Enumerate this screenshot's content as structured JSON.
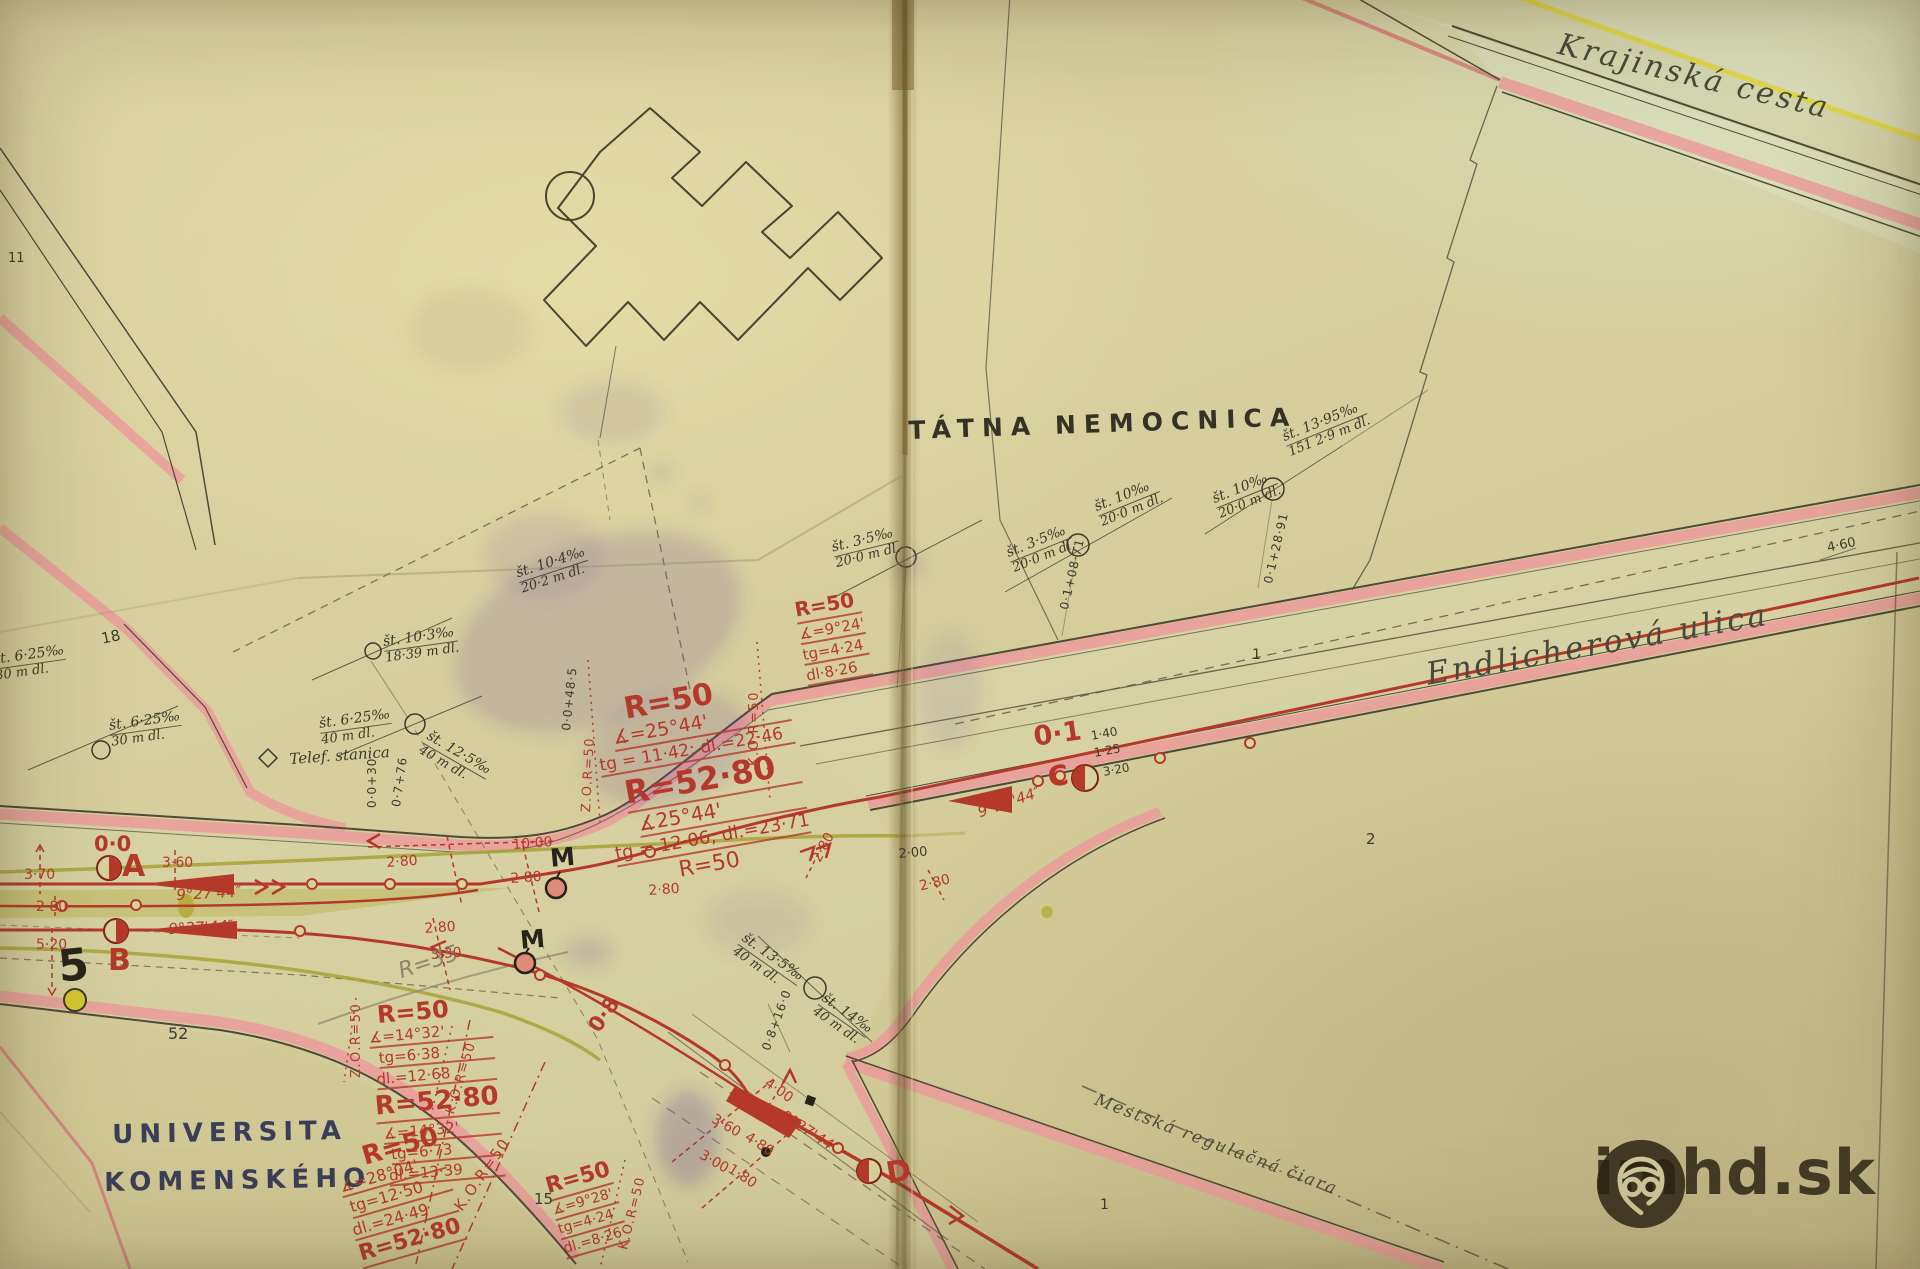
{
  "s": {
    "krajinska": "Krajinská cesta",
    "endlicherova": "Endlicherová ulica",
    "nemocnica": "TÁTNA NEMOCNICA",
    "universita1": "UNIVERSITA",
    "universita2": "KOMENSKÉHO",
    "regulacna": "Mestská regulačná čiara",
    "telef": "Telef. stanica",
    "r50": "R=50",
    "r5280": "R=52·80",
    "a2544": "∡=25°44'",
    "a2544b": "∡25°44'",
    "tg1142": "tg = 11·42; dl.=22·46",
    "tg1206": "tg = 12·06; dl.=23·71",
    "a924": "∡=9°24'",
    "tg424": "tg=4·24",
    "dl826": "dl·8·26",
    "a1432": "∡=14°32'",
    "tg638": "tg=6·38",
    "dl1268": "dl.=12·68",
    "tg673": "tg=6·73",
    "dl1339": "dl.=13·39",
    "a2804": "∡=28°04'",
    "tg1250": "tg=12·50",
    "dl2449": "dl.=24·49",
    "a928": "∡=9°28'",
    "dl826b": "dl.=8·26",
    "kor": "K.O.R=50",
    "zor": "Z.O.R=50",
    "ang927": "9°27'44″",
    "p00": "0·0",
    "p01": "0·1",
    "p08": "0·8",
    "A": "A",
    "B": "B",
    "C": "C",
    "D": "D",
    "M": "M",
    "n5": "5",
    "r35": "R=35",
    "d280": "2·80",
    "d330": "3·30",
    "d360": "3·60",
    "d370": "3·70",
    "d520": "5·20",
    "d1000": "10·00",
    "d140": "1·40",
    "d125": "1·25",
    "d320": "3·20",
    "d400": "4·00",
    "d480": "4·80",
    "d300": "3·00",
    "d180": "1·80",
    "d200": "2·00",
    "d460": "4·60",
    "n18": "18",
    "n11": "11",
    "n52": "52",
    "n15": "15",
    "n1": "1",
    "n2": "2",
    "g625": "št. 6·25‰",
    "g30": "30 m dl.",
    "g40": "40 m dl.",
    "g125": "št. 12·5‰",
    "g103": "št. 10·3‰",
    "g1839": "18·39 m dl.",
    "g104": "št. 10·4‰",
    "g202": "20·2 m dl.",
    "g35": "št. 3·5‰",
    "g200": "20·0 m dl.",
    "g10": "št. 10‰",
    "g1395": "št. 13·95‰",
    "g15129": "151 2·9 m dl.",
    "g135": "št. 13·5‰",
    "g14": "št. 14‰",
    "ch030": "0·0+30",
    "ch076": "0·7+76",
    "ch0485": "0·0+48·5",
    "ch10871": "0·1+08·71",
    "ch12891": "0·1+28·91",
    "ch0816": "0·8+16·0"
  },
  "watermark": {
    "text": "imhd.sk"
  },
  "colors": {
    "paper": "#d6cf9d",
    "pink": "#ec9a9b",
    "red": "#b5392b",
    "olive": "#a8a338",
    "yellow": "#e3d83f",
    "ink": "#3c3a2c"
  }
}
